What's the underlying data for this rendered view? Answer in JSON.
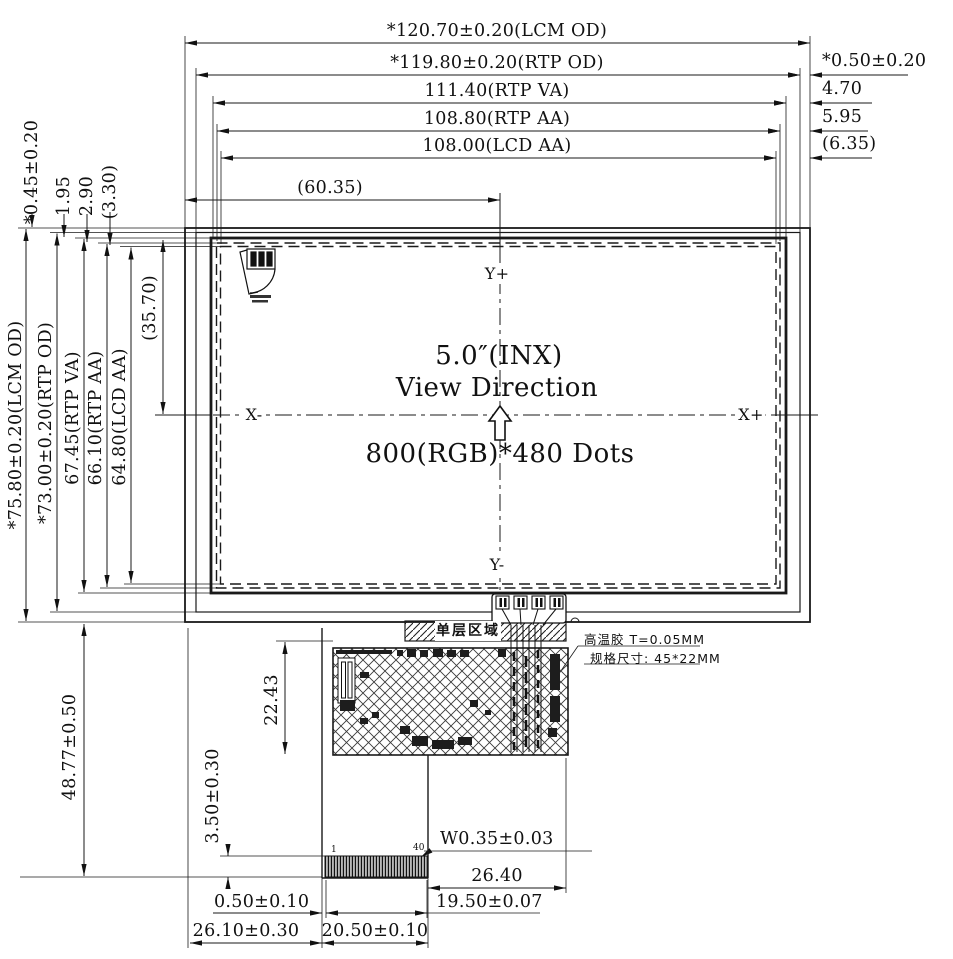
{
  "dims": {
    "lcm_od_w": "*120.70±0.20(LCM OD)",
    "rtp_od_w": "*119.80±0.20(RTP OD)",
    "rtp_va_w": "111.40(RTP VA)",
    "rtp_aa_w": "108.80(RTP AA)",
    "lcd_aa_w": "108.00(LCD AA)",
    "half_w": "(60.35)",
    "right_gap_rtp": "*0.50±0.20",
    "right_gap_va": "4.70",
    "right_gap_aa": "5.95",
    "right_gap_lcd": "(6.35)",
    "top_gap_rtp": "*0.45±0.20",
    "top_gap_va": "1.95",
    "top_gap_aa": "2.90",
    "top_gap_lcd": "(3.30)",
    "lcm_od_h": "*75.80±0.20(LCM OD)",
    "rtp_od_h": "*73.00±0.20(RTP OD)",
    "rtp_va_h": "67.45(RTP VA)",
    "rtp_aa_h": "66.10(RTP AA)",
    "lcd_aa_h": "64.80(LCD AA)",
    "half_h": "(35.70)",
    "fpc_drop": "48.77±0.50",
    "tape_h": "22.43",
    "finger_exposed": "3.50±0.30",
    "finger_w": "W0.35±0.03",
    "tail_to_body": "26.40",
    "finger_strip_w": "19.50±0.07",
    "finger_margin": "0.50±0.10",
    "tail_offset": "26.10±0.30",
    "tail_w": "20.50±0.10"
  },
  "axes": {
    "x_neg": "X-",
    "x_pos": "X+",
    "y_pos": "Y+",
    "y_neg": "Y-"
  },
  "center": {
    "size": "5.0″(INX)",
    "view": "View Direction",
    "resolution": "800(RGB)*480 Dots"
  },
  "fpc": {
    "band_label": "单层区域",
    "pin_first": "1",
    "pin_last": "40"
  },
  "callout": {
    "line1": "高温胶 T=0.05MM",
    "line2": "规格尺寸: 45*22MM"
  },
  "colors": {
    "line": "#1a1a1a",
    "bg": "#ffffff"
  }
}
